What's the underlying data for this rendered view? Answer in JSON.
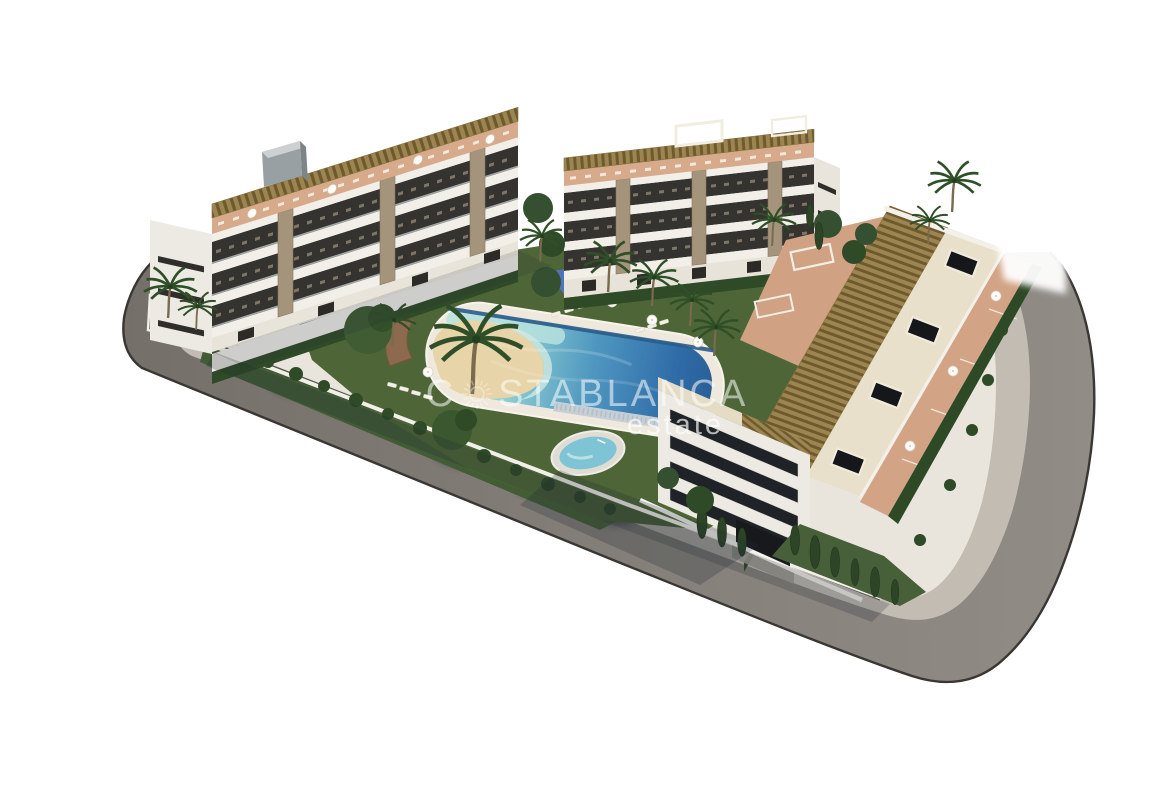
{
  "watermark": {
    "brand_prefix": "C",
    "brand_suffix": "STABLANCA",
    "tagline": "estate",
    "logo_icon": "sun-icon",
    "text_color": "#ffffff"
  },
  "scene": {
    "type": "aerial-3d-architectural-render",
    "subject": "residential apartment complex with lagoon pool, padel court and perimeter road",
    "background": "#ffffff"
  },
  "palette": {
    "background": "#ffffff",
    "road_asphalt": "#85807a",
    "road_edge": "#3a3633",
    "sidewalk": "#c3bcb2",
    "plot_base": "#e9e5dc",
    "building_white": "#f0ede7",
    "slab_cream": "#f2efe9",
    "glazing_dark": "#34332f",
    "pergola_brown": "#9c8550",
    "terrace_terracotta": "#d7aa8b",
    "stone_pillar": "#a5947c",
    "lawn_green": "#4e6637",
    "foliage_dark": "#2f4a27",
    "pool_shallow": "#c9e9e2",
    "pool_deep": "#2f6ca8",
    "sand_beach": "#e7d4a8",
    "padel_court_blue": "#5d82c6",
    "spa_water": "#7fc4d4",
    "watermark": "#ffffff"
  }
}
